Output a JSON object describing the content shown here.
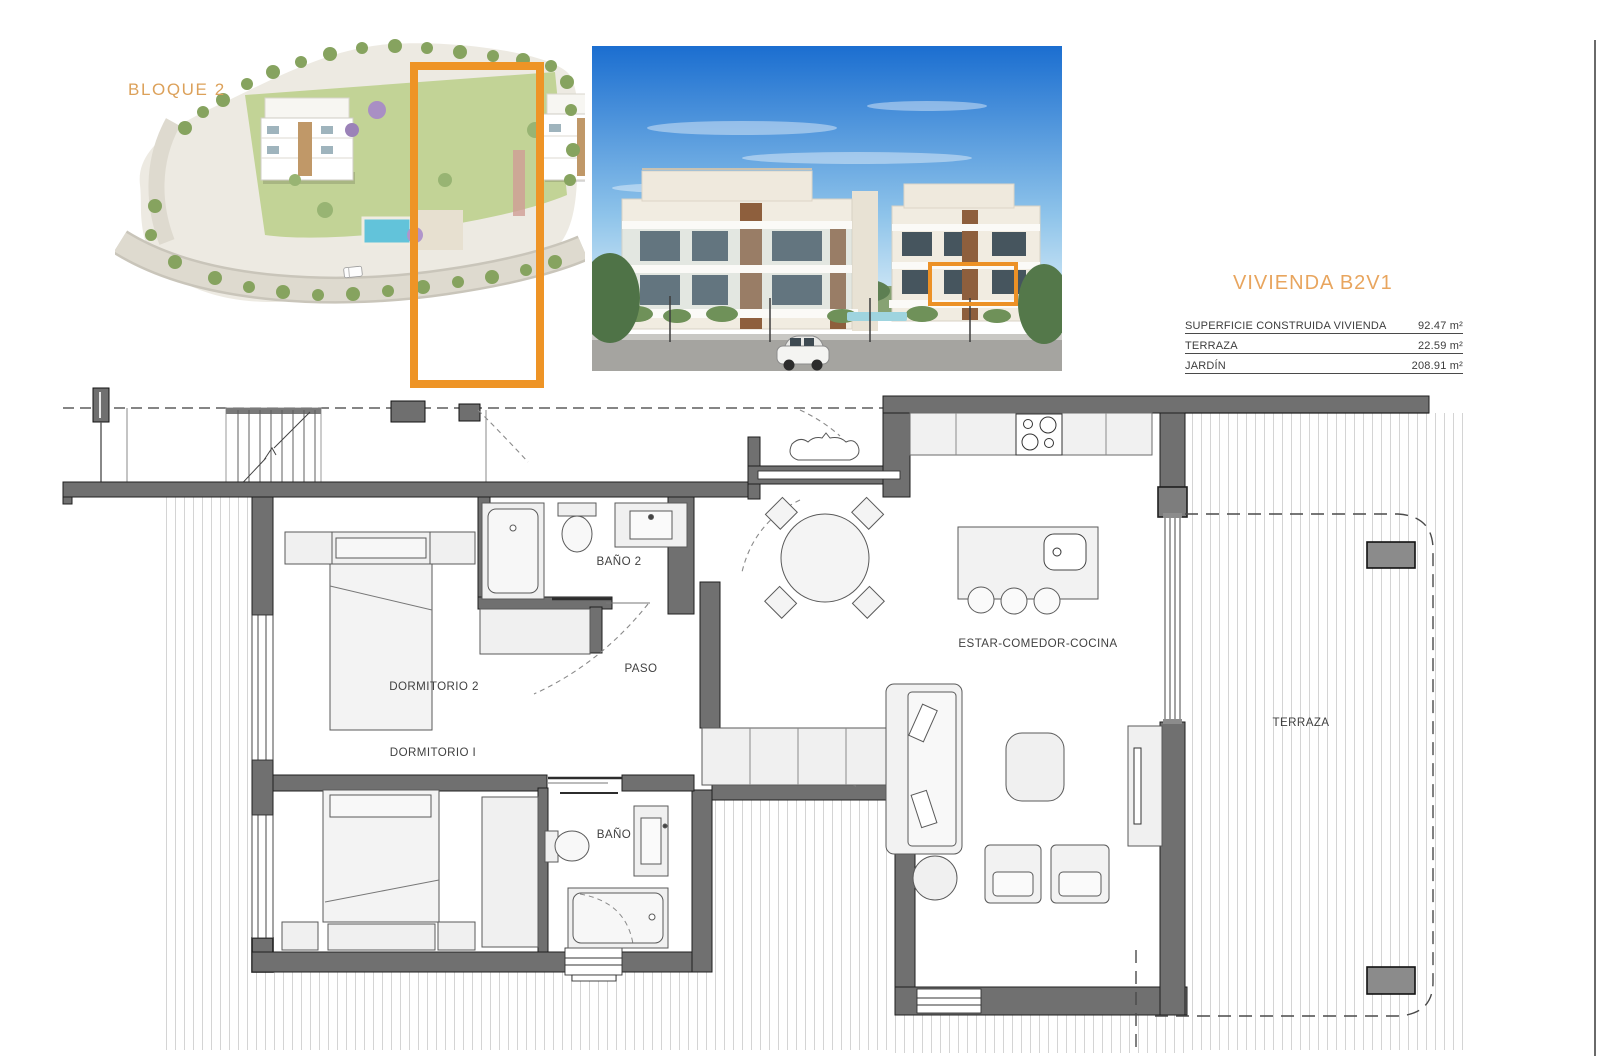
{
  "sheet": {
    "background": "#ffffff",
    "accent_orange": "#EE9426",
    "title_orange": "#E8A55E",
    "wall_color": "#707070",
    "hatch_color": "#d4d4d4"
  },
  "site_view": {
    "block_label": "BLOQUE 2"
  },
  "unit_panel": {
    "title": "VIVIENDA B2V1",
    "area_rows": [
      {
        "label": "SUPERFICIE CONSTRUIDA VIVIENDA",
        "value": "92.47 m²"
      },
      {
        "label": "TERRAZA",
        "value": "22.59 m²"
      },
      {
        "label": "JARDÍN",
        "value": "208.91 m²"
      }
    ]
  },
  "floor_plan": {
    "labels": {
      "bano2": "BAÑO 2",
      "paso": "PASO",
      "dormitorio2": "DORMITORIO 2",
      "dormitorio1": "DORMITORIO I",
      "bano": "BAÑO",
      "estar": "ESTAR-COMEDOR-COCINA",
      "terraza": "TERRAZA"
    }
  }
}
